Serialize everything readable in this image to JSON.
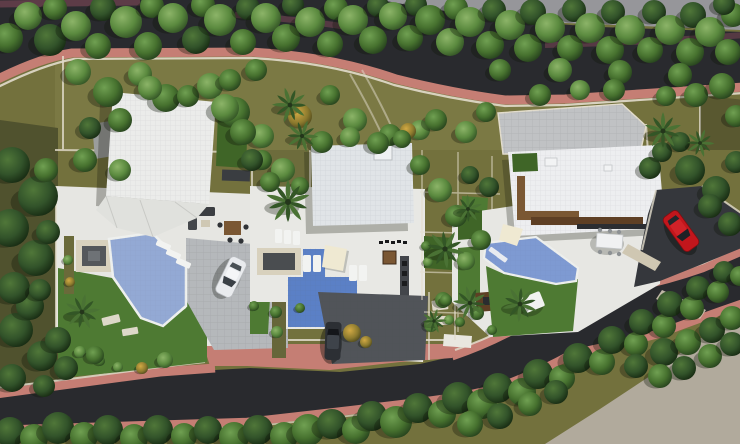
{
  "meta": {
    "description": "Aerial top-down 3D architectural rendering of a residential site plan: three modern white villas with terraces, swimming pools, gardens and driveways, set between two curving tree-lined asphalt roads with pink cobblestone sidewalks."
  },
  "palette": {
    "ground_olive": "#73713d",
    "ground_olive_light": "#7b7944",
    "ground_dark": "#50522e",
    "ground_gray": "#96969a",
    "ground_beige": "#b1aa9c",
    "asphalt": "#292a2e",
    "cobble_pink": "#c57e74",
    "cobble_maroon": "#5d3c47",
    "wall_cream": "#e2dccc",
    "terrace": "#e6e6e2",
    "drive_gray": "#b5b8bb",
    "drive_cobble": "#c0c2c4",
    "drive_dark": "#515459",
    "drive_darker": "#35373c",
    "roof_left": "#ebecea",
    "roof_middle": "#e0e4e7",
    "roof_right": "#edeef0",
    "pool_light": "#93a9d4",
    "pool_mosaic": "#5b80c6",
    "pool_right": "#7e9ad2",
    "lawn": "#4e7a33",
    "lawn_dark": "#3f6527",
    "wood": "#7a5733",
    "wood_dark": "#5e3f24",
    "car_white": "#e9ebee",
    "car_dark": "#2c2f34",
    "car_red": "#c2161c",
    "sail": "#efe9d2"
  },
  "site": {
    "roads": [
      {
        "id": "top-road"
      },
      {
        "id": "bottom-road"
      }
    ],
    "villas": [
      {
        "id": "left-villa"
      },
      {
        "id": "middle-villa"
      },
      {
        "id": "right-villa"
      }
    ],
    "pools": [
      {
        "id": "left-villa-pool"
      },
      {
        "id": "middle-villa-pool"
      },
      {
        "id": "right-villa-pool"
      }
    ],
    "cars": [
      {
        "id": "white-car"
      },
      {
        "id": "dark-car"
      },
      {
        "id": "red-car"
      }
    ]
  },
  "vegetation": {
    "trees": [
      [
        8,
        38,
        15,
        2
      ],
      [
        28,
        16,
        14,
        1
      ],
      [
        50,
        40,
        16,
        3
      ],
      [
        55,
        8,
        12,
        2
      ],
      [
        76,
        26,
        15,
        1
      ],
      [
        98,
        46,
        13,
        2
      ],
      [
        103,
        8,
        13,
        3
      ],
      [
        126,
        22,
        16,
        1
      ],
      [
        148,
        46,
        14,
        2
      ],
      [
        152,
        6,
        12,
        2
      ],
      [
        173,
        18,
        15,
        1
      ],
      [
        196,
        40,
        14,
        3
      ],
      [
        203,
        5,
        12,
        2
      ],
      [
        220,
        20,
        16,
        1
      ],
      [
        243,
        42,
        13,
        2
      ],
      [
        248,
        8,
        12,
        3
      ],
      [
        266,
        18,
        15,
        1
      ],
      [
        286,
        38,
        14,
        2
      ],
      [
        293,
        5,
        11,
        3
      ],
      [
        310,
        22,
        15,
        1
      ],
      [
        330,
        44,
        13,
        2
      ],
      [
        336,
        8,
        12,
        2
      ],
      [
        353,
        20,
        15,
        1
      ],
      [
        373,
        40,
        14,
        2
      ],
      [
        378,
        6,
        11,
        3
      ],
      [
        393,
        16,
        14,
        1
      ],
      [
        410,
        38,
        13,
        2
      ],
      [
        416,
        5,
        11,
        3
      ],
      [
        430,
        20,
        15,
        2
      ],
      [
        450,
        42,
        14,
        1
      ],
      [
        456,
        8,
        12,
        2
      ],
      [
        470,
        22,
        15,
        1
      ],
      [
        490,
        45,
        14,
        2
      ],
      [
        494,
        10,
        12,
        3
      ],
      [
        510,
        25,
        15,
        1
      ],
      [
        528,
        48,
        14,
        2
      ],
      [
        533,
        12,
        13,
        3
      ],
      [
        550,
        28,
        15,
        1
      ],
      [
        570,
        48,
        13,
        2
      ],
      [
        574,
        10,
        12,
        3
      ],
      [
        590,
        28,
        15,
        1
      ],
      [
        610,
        50,
        14,
        2
      ],
      [
        613,
        12,
        12,
        3
      ],
      [
        630,
        30,
        15,
        1
      ],
      [
        650,
        50,
        13,
        2
      ],
      [
        654,
        12,
        12,
        3
      ],
      [
        670,
        30,
        15,
        1
      ],
      [
        690,
        52,
        14,
        2
      ],
      [
        693,
        15,
        13,
        3
      ],
      [
        710,
        32,
        15,
        1
      ],
      [
        728,
        52,
        13,
        2
      ],
      [
        733,
        15,
        12,
        2
      ],
      [
        724,
        4,
        11,
        3
      ],
      [
        10,
        432,
        15,
        3
      ],
      [
        34,
        438,
        14,
        2
      ],
      [
        58,
        428,
        16,
        3
      ],
      [
        84,
        436,
        14,
        2
      ],
      [
        108,
        430,
        15,
        3
      ],
      [
        134,
        438,
        14,
        2
      ],
      [
        158,
        430,
        15,
        3
      ],
      [
        184,
        436,
        13,
        2
      ],
      [
        208,
        430,
        14,
        3
      ],
      [
        234,
        437,
        15,
        2
      ],
      [
        258,
        430,
        15,
        3
      ],
      [
        284,
        436,
        14,
        2
      ],
      [
        308,
        430,
        16,
        2
      ],
      [
        332,
        424,
        15,
        3
      ],
      [
        356,
        430,
        14,
        2
      ],
      [
        372,
        416,
        15,
        3
      ],
      [
        396,
        422,
        16,
        2
      ],
      [
        418,
        408,
        15,
        3
      ],
      [
        442,
        414,
        14,
        2
      ],
      [
        458,
        398,
        16,
        3
      ],
      [
        482,
        404,
        15,
        2
      ],
      [
        498,
        388,
        15,
        3
      ],
      [
        522,
        392,
        14,
        2
      ],
      [
        538,
        374,
        15,
        3
      ],
      [
        562,
        378,
        13,
        2
      ],
      [
        578,
        358,
        15,
        3
      ],
      [
        602,
        362,
        13,
        2
      ],
      [
        612,
        340,
        14,
        3
      ],
      [
        636,
        344,
        12,
        2
      ],
      [
        642,
        322,
        13,
        3
      ],
      [
        664,
        326,
        12,
        2
      ],
      [
        670,
        304,
        13,
        3
      ],
      [
        692,
        308,
        12,
        2
      ],
      [
        698,
        288,
        12,
        3
      ],
      [
        718,
        292,
        11,
        2
      ],
      [
        724,
        272,
        11,
        3
      ],
      [
        740,
        276,
        10,
        2
      ],
      [
        470,
        424,
        13,
        2
      ],
      [
        500,
        416,
        13,
        3
      ],
      [
        530,
        404,
        12,
        2
      ],
      [
        556,
        392,
        12,
        3
      ],
      [
        664,
        352,
        14,
        3
      ],
      [
        688,
        342,
        13,
        2
      ],
      [
        712,
        330,
        13,
        3
      ],
      [
        684,
        368,
        12,
        3
      ],
      [
        710,
        356,
        12,
        2
      ],
      [
        732,
        344,
        12,
        3
      ],
      [
        660,
        376,
        12,
        2
      ],
      [
        636,
        366,
        12,
        3
      ],
      [
        732,
        318,
        12,
        2
      ],
      [
        16,
        330,
        17,
        3
      ],
      [
        42,
        356,
        15,
        3
      ],
      [
        12,
        378,
        14,
        3
      ],
      [
        58,
        340,
        13,
        3
      ],
      [
        30,
        306,
        14,
        3
      ],
      [
        66,
        368,
        12,
        3
      ],
      [
        44,
        386,
        11,
        3
      ],
      [
        12,
        165,
        18,
        3
      ],
      [
        38,
        196,
        20,
        3
      ],
      [
        10,
        228,
        19,
        3
      ],
      [
        36,
        258,
        18,
        3
      ],
      [
        14,
        288,
        16,
        3
      ],
      [
        46,
        170,
        12,
        2
      ],
      [
        48,
        232,
        12,
        3
      ],
      [
        40,
        290,
        11,
        3
      ],
      [
        78,
        72,
        13,
        1
      ],
      [
        108,
        92,
        15,
        2
      ],
      [
        140,
        74,
        12,
        1
      ],
      [
        166,
        98,
        14,
        2
      ],
      [
        120,
        120,
        12,
        2
      ],
      [
        90,
        128,
        11,
        3
      ],
      [
        150,
        88,
        12,
        1
      ],
      [
        188,
        96,
        11,
        2
      ],
      [
        210,
        86,
        13,
        1
      ],
      [
        235,
        112,
        15,
        2
      ],
      [
        256,
        70,
        11,
        2
      ],
      [
        262,
        136,
        12,
        1
      ],
      [
        283,
        170,
        12,
        1
      ],
      [
        262,
        160,
        10,
        2
      ],
      [
        300,
        186,
        9,
        2
      ],
      [
        330,
        95,
        10,
        2
      ],
      [
        355,
        120,
        12,
        1
      ],
      [
        390,
        135,
        11,
        2
      ],
      [
        420,
        130,
        10,
        1
      ],
      [
        436,
        120,
        11,
        2
      ],
      [
        466,
        132,
        11,
        1
      ],
      [
        486,
        112,
        10,
        2
      ],
      [
        225,
        108,
        14,
        1
      ],
      [
        243,
        132,
        13,
        2
      ],
      [
        252,
        160,
        11,
        3
      ],
      [
        270,
        182,
        10,
        2
      ],
      [
        300,
        116,
        12,
        4
      ],
      [
        408,
        131,
        8,
        4
      ],
      [
        85,
        160,
        12,
        2
      ],
      [
        120,
        170,
        11,
        1
      ],
      [
        230,
        80,
        11,
        2
      ],
      [
        322,
        142,
        11,
        2
      ],
      [
        350,
        137,
        10,
        1
      ],
      [
        378,
        143,
        11,
        2
      ],
      [
        402,
        139,
        9,
        2
      ],
      [
        420,
        165,
        10,
        2
      ],
      [
        440,
        190,
        12,
        1
      ],
      [
        456,
        216,
        11,
        2
      ],
      [
        470,
        175,
        9,
        3
      ],
      [
        481,
        240,
        10,
        2
      ],
      [
        466,
        261,
        9,
        1
      ],
      [
        443,
        300,
        8,
        2
      ],
      [
        431,
        325,
        7,
        1
      ],
      [
        477,
        313,
        7,
        2
      ],
      [
        489,
        187,
        10,
        3
      ],
      [
        690,
        170,
        15,
        3
      ],
      [
        716,
        190,
        14,
        3
      ],
      [
        710,
        206,
        12,
        3
      ],
      [
        730,
        224,
        12,
        3
      ],
      [
        736,
        162,
        11,
        3
      ],
      [
        696,
        95,
        12,
        2
      ],
      [
        722,
        86,
        13,
        2
      ],
      [
        736,
        116,
        11,
        2
      ],
      [
        666,
        96,
        10,
        2
      ],
      [
        650,
        168,
        11,
        3
      ],
      [
        662,
        152,
        10,
        3
      ],
      [
        680,
        142,
        10,
        3
      ],
      [
        500,
        70,
        11,
        2
      ],
      [
        560,
        70,
        12,
        1
      ],
      [
        620,
        72,
        12,
        2
      ],
      [
        680,
        75,
        12,
        2
      ],
      [
        540,
        95,
        11,
        2
      ],
      [
        580,
        90,
        10,
        1
      ],
      [
        614,
        90,
        11,
        2
      ],
      [
        80,
        352,
        6,
        1
      ],
      [
        100,
        361,
        5,
        2
      ],
      [
        118,
        367,
        5,
        1
      ],
      [
        142,
        368,
        6,
        4
      ],
      [
        276,
        312,
        6,
        2
      ],
      [
        277,
        332,
        6,
        1
      ],
      [
        300,
        308,
        5,
        2
      ],
      [
        352,
        333,
        9,
        4
      ],
      [
        366,
        342,
        6,
        4
      ],
      [
        446,
        300,
        6,
        2
      ],
      [
        449,
        320,
        5,
        1
      ],
      [
        460,
        322,
        5,
        2
      ],
      [
        68,
        260,
        5,
        1
      ],
      [
        70,
        282,
        5,
        4
      ],
      [
        254,
        306,
        5,
        2
      ],
      [
        426,
        246,
        5,
        2
      ],
      [
        428,
        262,
        5,
        1
      ],
      [
        492,
        330,
        5,
        2
      ],
      [
        95,
        355,
        9,
        2
      ],
      [
        165,
        360,
        8,
        1
      ]
    ],
    "palms": [
      [
        82,
        312,
        1.0,
        10
      ],
      [
        288,
        202,
        1.25,
        0
      ],
      [
        290,
        105,
        1.0,
        55
      ],
      [
        302,
        136,
        0.9,
        20
      ],
      [
        445,
        249,
        1.1,
        30
      ],
      [
        470,
        303,
        0.95,
        60
      ],
      [
        434,
        321,
        0.7,
        15
      ],
      [
        663,
        131,
        1.05,
        0
      ],
      [
        520,
        304,
        1.0,
        40
      ],
      [
        468,
        209,
        0.8,
        70
      ],
      [
        700,
        143,
        0.8,
        20
      ]
    ]
  }
}
